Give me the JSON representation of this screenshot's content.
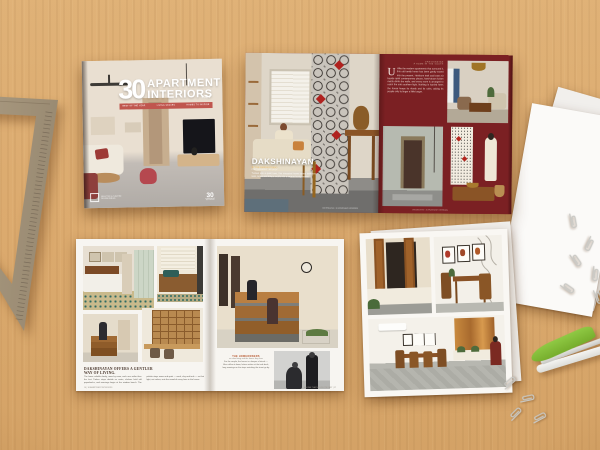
{
  "colors": {
    "maroon": "#7b2023",
    "accent_red": "#b3261e",
    "band_red": "#c0564e",
    "desk_wood": "#d7a263",
    "stapler_green": "#83bd3f"
  },
  "cover": {
    "number": "30",
    "title_line1": "APARTMENT",
    "title_line2": "INTERIORS",
    "year": "2024",
    "band_items": [
      "BEST OF THE YEAR",
      "LIVING SPACES",
      "HOMES TO INSPIRE"
    ],
    "publisher_line1": "SELECTED & CURATED",
    "publisher_line2": "DESIGN ANNUAL",
    "badge_number": "30",
    "badge_caption": "APARTMENT INTERIORS"
  },
  "feature": {
    "title": "DAKSHINAYAN",
    "byline": "BY THE DESIGN STUDIO",
    "credit": "PHOTOGRAPHY · AS SHOT",
    "intro": "Tucked into a quiet lane, this ancestral home layers heirloom teak, brass and kolam motifs into a serene family retreat.",
    "kicker_line1": "DAKSHINAYAN",
    "kicker_line2": "A HOME IN THE SOUTH",
    "dropcap": "U",
    "body": "nlike the modern apartments that surround it, this old family home has been gently eased into the present. Heirloom teak and brass sit beside quiet contemporary pieces, hand-drawn kolam motifs climb the walls, and every room is arranged to catch the soft southern light. Nothing is hurried here; the house keeps its rituals and its calm, asking its people only to linger a little longer.",
    "caption": "DAKSHINAYAN · 30 APARTMENT INTERIORS"
  },
  "story": {
    "headline_line1": "DAKSHINAYAN OFFERS A GENTLER",
    "headline_line2": "WAY OF LIVING.",
    "body": "The home unfolds slowly, room by room, each one softer than the last. Timber steps double as seats, shelves hold old paperbacks, and mornings begin at the window bench. The palette stays warm and quiet — sand, clay and teak — so that light, not colour, sets the mood of every hour in the house.",
    "footer_left": "16 | 30 APARTMENT INTERIORS",
    "bio_heading": "THE HOMEOWNERS",
    "bio_sub": "on slow living and the house they love",
    "bio_body": "For the couple, the house is a keeper of rituals — filter coffee at dawn, letters written at the teak desk, long evenings on the steps watching the street go by.",
    "footer_right": "A HOME THAT HOLDS ITS PAST | 17"
  }
}
